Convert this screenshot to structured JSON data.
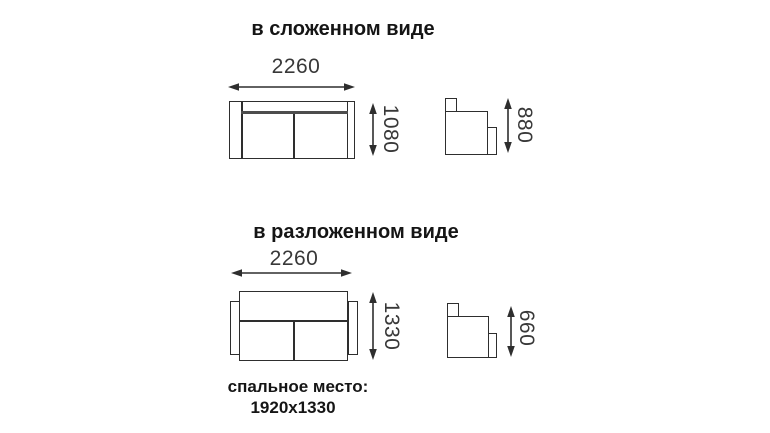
{
  "folded": {
    "title": "в сложенном виде",
    "width": "2260",
    "depth": "1080",
    "height": "880"
  },
  "unfolded": {
    "title": "в разложенном виде",
    "width": "2260",
    "depth": "1330",
    "height": "660"
  },
  "sleeping": {
    "label": "спальное место:",
    "size": "1920x1330"
  },
  "colors": {
    "line": "#2e2e2e",
    "dim_text": "#383838",
    "title_text": "#151515",
    "background": "#ffffff"
  }
}
